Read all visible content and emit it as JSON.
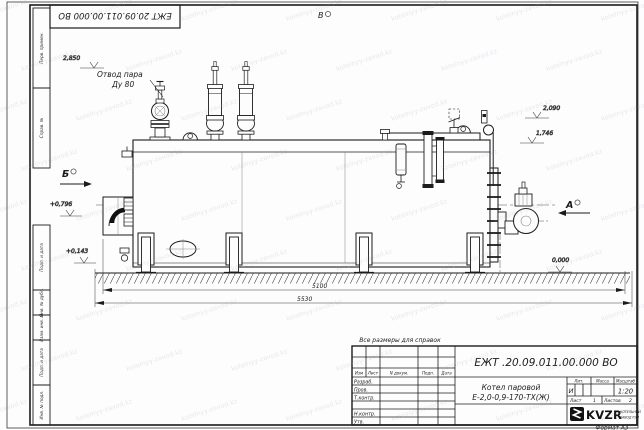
{
  "watermark": {
    "text": "kotelnyy-zavod.kz"
  },
  "frame": {
    "top_stamp": "ЕЖТ 20.09.011.00.000  ВО",
    "side_labels": [
      "Перв. примен.",
      "Справ. №",
      "Подп. и дата",
      "Инв. № дубл.",
      "Взам. инв. №",
      "Подп. и дата",
      "Инв. № подл."
    ],
    "format_note": "Формат А3"
  },
  "drawing": {
    "callouts": {
      "steam_outlet_line1": "Отвод пара",
      "steam_outlet_line2": "Ду 80",
      "reference_note": "Все размеры для справок"
    },
    "view_labels": {
      "top": "В",
      "left": "Б",
      "right": "А"
    },
    "elevations": {
      "valve_top": "2,850",
      "gauge_top": "2,090",
      "drum_top": "1,746",
      "burner_axis": "+0,796",
      "casing_bottom": "+0,143",
      "ground": "0,000"
    },
    "dimensions": {
      "length_casing": "5100",
      "length_overall": "5530"
    }
  },
  "title_block": {
    "doc_number": "ЕЖТ .20.09.011.00.000  ВО",
    "product_line1": "Котел паровой",
    "product_line2": "Е-2,0-0,9-170-ТХ(Ж)",
    "col_headers": {
      "izm": "Изм",
      "list": "Лист",
      "doc": "N докум.",
      "podp": "Подп.",
      "data": "Дата"
    },
    "row_labels": {
      "razrab": "Разраб.",
      "prov": "Пров.",
      "tkontr": "Т.контр.",
      "nkontr": "Н.контр.",
      "utv": "Утв."
    },
    "lit_header": "Лит.",
    "lit_value": "И",
    "mass_header": "Масса",
    "scale_header": "Масштаб",
    "scale_value": "1:20",
    "sheet_label": "Лист",
    "sheet_value": "1",
    "sheets_label": "Листов",
    "sheets_value": "2",
    "company": {
      "logo_text": "KVZR",
      "name_line1": "КОТЕЛЬНЫЙ",
      "name_line2": "ЗАВОД РЭП"
    }
  }
}
